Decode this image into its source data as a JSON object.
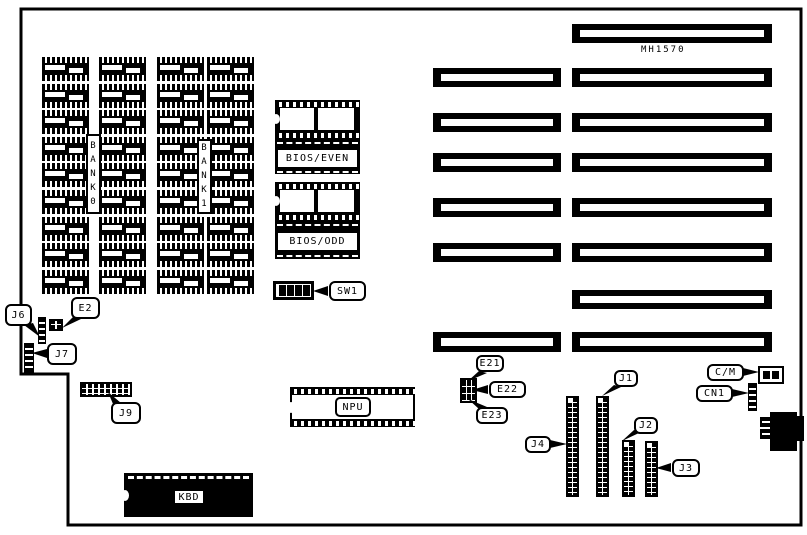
{
  "colors": {
    "ink": "#000000",
    "paper": "#ffffff"
  },
  "board": {
    "model_label": "MH1570"
  },
  "banks": {
    "bank0": "BANK0",
    "bank1": "BANK1"
  },
  "bios": {
    "even": "BIOS/EVEN",
    "odd": "BIOS/ODD"
  },
  "chips": {
    "npu": "NPU",
    "kbd": "KBD"
  },
  "memory_grid": {
    "cols": [
      42,
      99,
      157,
      207
    ],
    "rows": 9,
    "row_start": 57,
    "row_pitch": 26.6,
    "chip_w": 47,
    "chip_h": 24
  },
  "slots": [
    {
      "x": 572,
      "y": 24,
      "w": 200,
      "h": 19
    },
    {
      "x": 433,
      "y": 68,
      "w": 128,
      "h": 19
    },
    {
      "x": 572,
      "y": 68,
      "w": 200,
      "h": 19
    },
    {
      "x": 433,
      "y": 113,
      "w": 128,
      "h": 19
    },
    {
      "x": 572,
      "y": 113,
      "w": 200,
      "h": 19
    },
    {
      "x": 433,
      "y": 153,
      "w": 128,
      "h": 19
    },
    {
      "x": 572,
      "y": 153,
      "w": 200,
      "h": 19
    },
    {
      "x": 433,
      "y": 198,
      "w": 128,
      "h": 19
    },
    {
      "x": 572,
      "y": 198,
      "w": 200,
      "h": 19
    },
    {
      "x": 433,
      "y": 243,
      "w": 128,
      "h": 19
    },
    {
      "x": 572,
      "y": 243,
      "w": 200,
      "h": 19
    },
    {
      "x": 572,
      "y": 290,
      "w": 200,
      "h": 19
    },
    {
      "x": 433,
      "y": 332,
      "w": 128,
      "h": 20
    },
    {
      "x": 572,
      "y": 332,
      "w": 200,
      "h": 20
    }
  ],
  "pin_headers": [
    {
      "id": "J4",
      "x": 566,
      "y": 396,
      "w": 13,
      "h": 101
    },
    {
      "id": "J1",
      "x": 596,
      "y": 396,
      "w": 13,
      "h": 101
    },
    {
      "id": "J2",
      "x": 622,
      "y": 440,
      "w": 13,
      "h": 57
    },
    {
      "id": "J3",
      "x": 645,
      "y": 441,
      "w": 13,
      "h": 56
    }
  ],
  "pin_strips": [
    {
      "id": "J6",
      "x": 38,
      "y": 317,
      "w": 8,
      "h": 27
    },
    {
      "id": "J7",
      "x": 24,
      "y": 343,
      "w": 10,
      "h": 30
    },
    {
      "id": "CN1",
      "x": 748,
      "y": 383,
      "w": 9,
      "h": 28
    }
  ],
  "jumper_blocks": [
    {
      "id": "E2",
      "x": 49,
      "y": 319,
      "w": 14,
      "h": 12,
      "cols": 2
    },
    {
      "id": "E21-E23",
      "x": 460,
      "y": 378,
      "w": 17,
      "h": 25,
      "cols": 3
    }
  ],
  "sw1": {
    "positions": 4
  },
  "cm_jumper": {
    "positions": 2
  },
  "callouts": [
    {
      "id": "J6",
      "label": "J6",
      "x": 5,
      "y": 304,
      "w": 27,
      "h": 22,
      "tail": "24,325 33,323 40,337"
    },
    {
      "id": "E2",
      "label": "E2",
      "x": 71,
      "y": 297,
      "w": 29,
      "h": 22,
      "tail": "73,317 81,319 62,328"
    },
    {
      "id": "J7",
      "label": "J7",
      "x": 47,
      "y": 343,
      "w": 30,
      "h": 22,
      "tail": "47,349 47,358 32,353"
    },
    {
      "id": "J9",
      "label": "J9",
      "x": 111,
      "y": 402,
      "w": 30,
      "h": 22,
      "tail": "113,404 121,403 108,392"
    },
    {
      "id": "SW1",
      "label": "SW1",
      "x": 329,
      "y": 281,
      "w": 37,
      "h": 20,
      "tail": "328,286 328,296 313,291"
    },
    {
      "id": "E21",
      "label": "E21",
      "x": 476,
      "y": 355,
      "w": 28,
      "h": 17,
      "tail": "479,371 487,373 468,381"
    },
    {
      "id": "E22",
      "label": "E22",
      "x": 489,
      "y": 381,
      "w": 37,
      "h": 17,
      "tail": "488,385 488,394 472,390"
    },
    {
      "id": "E23",
      "label": "E23",
      "x": 476,
      "y": 407,
      "w": 32,
      "h": 17,
      "tail": "479,409 487,407 468,399"
    },
    {
      "id": "J1",
      "label": "J1",
      "x": 614,
      "y": 370,
      "w": 24,
      "h": 17,
      "tail": "614,385 621,387 602,396"
    },
    {
      "id": "J4",
      "label": "J4",
      "x": 525,
      "y": 436,
      "w": 26,
      "h": 17,
      "tail": "550,440 550,448 567,444"
    },
    {
      "id": "J2",
      "label": "J2",
      "x": 634,
      "y": 417,
      "w": 24,
      "h": 17,
      "tail": "634,430 641,432 622,441"
    },
    {
      "id": "J3",
      "label": "J3",
      "x": 672,
      "y": 459,
      "w": 28,
      "h": 18,
      "tail": "671,463 671,472 656,468"
    },
    {
      "id": "C/M",
      "label": "C/M",
      "x": 707,
      "y": 364,
      "w": 37,
      "h": 17,
      "tail": "743,368 743,376 759,372"
    },
    {
      "id": "CN1",
      "label": "CN1",
      "x": 696,
      "y": 385,
      "w": 37,
      "h": 17,
      "tail": "732,389 732,397 749,393"
    }
  ]
}
